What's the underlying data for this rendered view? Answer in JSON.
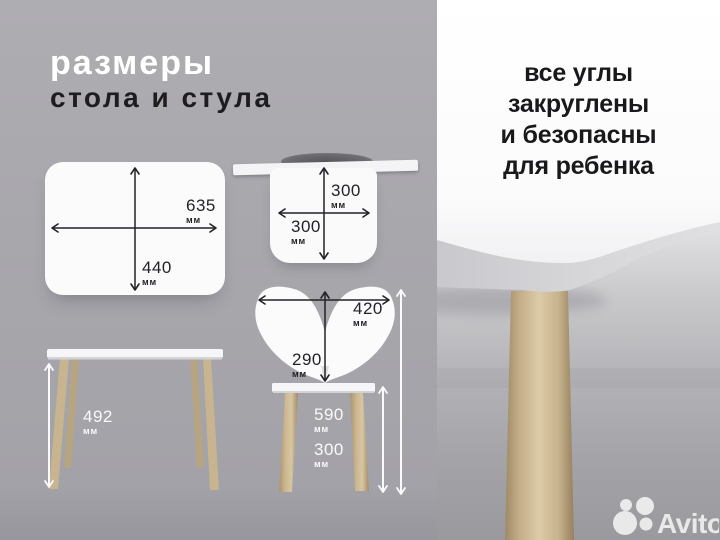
{
  "left_panel": {
    "title_line1": "размеры",
    "title_line2": "стола и стула",
    "tabletop_diagram": {
      "width": {
        "value": "635",
        "unit": "мм"
      },
      "depth": {
        "value": "440",
        "unit": "мм"
      }
    },
    "seat_diagram": {
      "depth": {
        "value": "300",
        "unit": "мм"
      },
      "width": {
        "value": "300",
        "unit": "мм"
      }
    },
    "chair_diagram": {
      "back_width": {
        "value": "420",
        "unit": "мм"
      },
      "back_height": {
        "value": "290",
        "unit": "мм"
      },
      "total_height": {
        "value": "590",
        "unit": "мм"
      },
      "seat_height": {
        "value": "300",
        "unit": "мм"
      }
    },
    "table_side_diagram": {
      "height": {
        "value": "492",
        "unit": "мм"
      }
    }
  },
  "right_panel": {
    "caption": {
      "line1": "все углы",
      "line2": "закруглены",
      "line3": "и безопасны",
      "line4": "для ребенка"
    },
    "watermark": "Avito"
  },
  "colors": {
    "panel_gray": "#a8a7ac",
    "shape_white": "#fbfbfc",
    "arrow_black": "#232327",
    "arrow_white": "#fafafa",
    "wood": "#c7b28c",
    "text_dark": "#1d1d1f"
  }
}
